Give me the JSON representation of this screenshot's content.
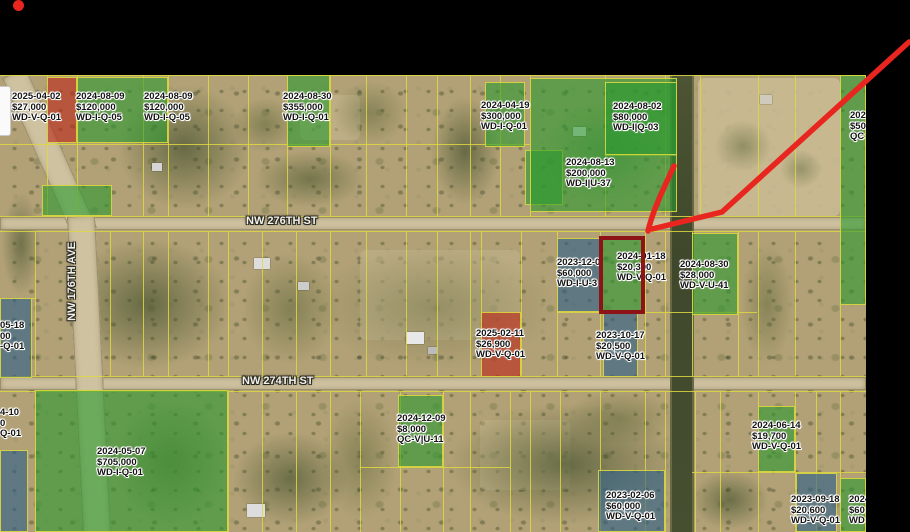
{
  "screen": {
    "width": 910,
    "height": 532,
    "background": "#000000"
  },
  "recording_indicator": {
    "shape": "dot",
    "color": "#e8251f"
  },
  "annotation": {
    "arrow_color": "#e8251f",
    "highlighted_parcel": {
      "x": 599,
      "y": 236,
      "w": 46,
      "h": 78,
      "border_color": "#8e1317"
    }
  },
  "map": {
    "base_color": "#b2a176",
    "colors": {
      "green": "rgba(42,153,47,0.60)",
      "blue": "rgba(45,95,135,0.62)",
      "red": "rgba(185,40,25,0.62)",
      "grid": "#ded83f",
      "road": "#cfc2a0"
    },
    "streets": [
      {
        "id": "nw-276th-st",
        "label": "NW 276TH ST",
        "orientation": "horizontal",
        "x": 246,
        "y": 215
      },
      {
        "id": "nw-274th-st",
        "label": "NW 274TH ST",
        "orientation": "horizontal",
        "x": 242,
        "y": 375
      },
      {
        "id": "nw-176th-ave",
        "label": "NW 176TH AVE",
        "orientation": "vertical",
        "x": 66,
        "y": 242
      }
    ],
    "parcels": [
      {
        "color": "red",
        "x": 47,
        "y": 77,
        "w": 30,
        "h": 66
      },
      {
        "color": "green",
        "x": 77,
        "y": 77,
        "w": 91,
        "h": 66
      },
      {
        "color": "green",
        "x": 287,
        "y": 75,
        "w": 43,
        "h": 72
      },
      {
        "color": "green",
        "x": 485,
        "y": 82,
        "w": 40,
        "h": 65
      },
      {
        "color": "green",
        "x": 525,
        "y": 150,
        "w": 38,
        "h": 55
      },
      {
        "color": "green",
        "x": 530,
        "y": 78,
        "w": 147,
        "h": 134
      },
      {
        "color": "green",
        "x": 605,
        "y": 82,
        "w": 72,
        "h": 73
      },
      {
        "color": "green",
        "x": 840,
        "y": 75,
        "w": 26,
        "h": 230
      },
      {
        "color": "green",
        "x": 42,
        "y": 185,
        "w": 70,
        "h": 31
      },
      {
        "color": "green",
        "x": 692,
        "y": 233,
        "w": 46,
        "h": 82
      },
      {
        "color": "green",
        "x": 601,
        "y": 238,
        "w": 43,
        "h": 74
      },
      {
        "color": "blue",
        "x": 557,
        "y": 238,
        "w": 44,
        "h": 74
      },
      {
        "color": "blue",
        "x": 603,
        "y": 313,
        "w": 35,
        "h": 64
      },
      {
        "color": "red",
        "x": 481,
        "y": 312,
        "w": 40,
        "h": 65
      },
      {
        "color": "blue",
        "x": 0,
        "y": 298,
        "w": 32,
        "h": 80
      },
      {
        "color": "green",
        "x": 35,
        "y": 390,
        "w": 193,
        "h": 142
      },
      {
        "color": "blue",
        "x": 0,
        "y": 450,
        "w": 28,
        "h": 82
      },
      {
        "color": "green",
        "x": 398,
        "y": 395,
        "w": 45,
        "h": 72
      },
      {
        "color": "green",
        "x": 758,
        "y": 406,
        "w": 37,
        "h": 66
      },
      {
        "color": "blue",
        "x": 598,
        "y": 470,
        "w": 67,
        "h": 62
      },
      {
        "color": "blue",
        "x": 796,
        "y": 473,
        "w": 41,
        "h": 59
      },
      {
        "color": "green",
        "x": 840,
        "y": 478,
        "w": 26,
        "h": 54
      }
    ],
    "sale_labels": [
      {
        "date": "2025-04-02",
        "price": "$27,000",
        "code": "WD-V-Q-01",
        "x": 12,
        "y": 92
      },
      {
        "date": "2024-08-09",
        "price": "$120,000",
        "code": "WD-I-Q-05",
        "x": 76,
        "y": 92
      },
      {
        "date": "2024-08-09",
        "price": "$120,000",
        "code": "WD-I-Q-05",
        "x": 144,
        "y": 92
      },
      {
        "date": "2024-08-30",
        "price": "$355,000",
        "code": "WD-I-Q-01",
        "x": 283,
        "y": 92
      },
      {
        "date": "2024-04-19",
        "price": "$300,000",
        "code": "WD-I-Q-01",
        "x": 481,
        "y": 101
      },
      {
        "date": "2024-08-02",
        "price": "$80,000",
        "code": "WD-I|Q-03",
        "x": 613,
        "y": 102
      },
      {
        "date": "2024-08-13",
        "price": "$200,000",
        "code": "WD-I|U-37",
        "x": 566,
        "y": 158
      },
      {
        "date": "202",
        "price": "$50",
        "code": "QC",
        "x": 850,
        "y": 111
      },
      {
        "date": "2023-12-0",
        "price": "$60,000",
        "code": "WD-I-U-3",
        "x": 557,
        "y": 258
      },
      {
        "date": "2024-01-18",
        "price": "$20,300",
        "code": "WD-V-Q-01",
        "x": 617,
        "y": 252
      },
      {
        "date": "2024-08-30",
        "price": "$28,000",
        "code": "WD-V-U-41",
        "x": 680,
        "y": 260
      },
      {
        "date": "2025-02-11",
        "price": "$26,900",
        "code": "WD-V-Q-01",
        "x": 476,
        "y": 329
      },
      {
        "date": "2023-10-17",
        "price": "$20,500",
        "code": "WD-V-Q-01",
        "x": 596,
        "y": 331
      },
      {
        "date": "05-18",
        "price": "00",
        "code": "-Q-01",
        "x": 0,
        "y": 321
      },
      {
        "date": "4-10",
        "price": "0",
        "code": "Q-01",
        "x": 0,
        "y": 408
      },
      {
        "date": "2024-05-07",
        "price": "$705,000",
        "code": "WD-I-Q-01",
        "x": 97,
        "y": 447
      },
      {
        "date": "2024-12-09",
        "price": "$8,000",
        "code": "QC-V|U-11",
        "x": 397,
        "y": 414
      },
      {
        "date": "2024-06-14",
        "price": "$19,700",
        "code": "WD-V-Q-01",
        "x": 752,
        "y": 421
      },
      {
        "date": "2023-02-06",
        "price": "$60,000",
        "code": "WD-V-Q-01",
        "x": 606,
        "y": 491
      },
      {
        "date": "2023-09-18",
        "price": "$20,600",
        "code": "WD-V-Q-01",
        "x": 791,
        "y": 495
      },
      {
        "date": "2024",
        "price": "$60",
        "code": "WD",
        "x": 849,
        "y": 495
      }
    ]
  }
}
